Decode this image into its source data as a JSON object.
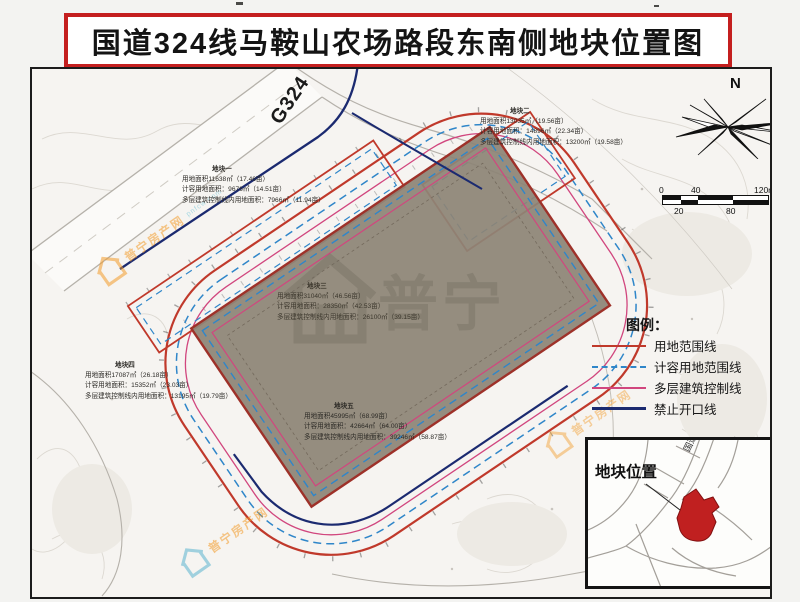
{
  "title": "国道324线马鞍山农场路段东南侧地块位置图",
  "map": {
    "highway_label": "G324",
    "compass_label": "N",
    "scale_bar": {
      "top_labels": [
        "0",
        "40",
        "120m"
      ],
      "bottom_labels": [
        "20",
        "80"
      ]
    },
    "plots": [
      {
        "name": "地块一",
        "area_line": "用地面积11638㎡（17.46亩）",
        "plot_ratio_line": "计容用地面积：9676㎡（14.51亩）",
        "control_line": "多层建筑控制线内用地面积：7966㎡（11.94亩）"
      },
      {
        "name": "地块二",
        "area_line": "用地面积13035㎡（19.56亩）",
        "plot_ratio_line": "计容用地面积：14896㎡（22.34亩）",
        "control_line": "多层建筑控制线内用地面积：13200㎡（19.58亩）"
      },
      {
        "name": "地块三",
        "area_line": "用地面积31040㎡（46.56亩）",
        "plot_ratio_line": "计容用地面积：28350㎡（42.53亩）",
        "control_line": "多层建筑控制线内用地面积：26100㎡（39.15亩）"
      },
      {
        "name": "地块四",
        "area_line": "用地面积17087㎡（26.18亩）",
        "plot_ratio_line": "计容用地面积：15352㎡（23.03亩）",
        "control_line": "多层建筑控制线内用地面积：13195㎡（19.79亩）"
      },
      {
        "name": "地块五",
        "area_line": "用地面积45995㎡（68.99亩）",
        "plot_ratio_line": "计容用地面积：42664㎡（64.00亩）",
        "control_line": "多层建筑控制线内用地面积：39246㎡（58.87亩）"
      }
    ]
  },
  "legend": {
    "title": "图例：",
    "items": [
      {
        "label": "用地范围线",
        "color": "#c0392b",
        "style": "solid"
      },
      {
        "label": "计容用地范围线",
        "color": "#2f86c9",
        "style": "dashed"
      },
      {
        "label": "多层建筑控制线",
        "color": "#d1467e",
        "style": "solid"
      },
      {
        "label": "禁止开口线",
        "color": "#1b2a70",
        "style": "solid"
      }
    ],
    "date": "2021年1月"
  },
  "inset": {
    "title": "地块位置",
    "road_label": "国道324线",
    "plot_color": "#c02020"
  },
  "watermark": {
    "brand_large": "普宁",
    "brand_small": "普宁房产网",
    "brand_url": "pnfcw.com"
  }
}
